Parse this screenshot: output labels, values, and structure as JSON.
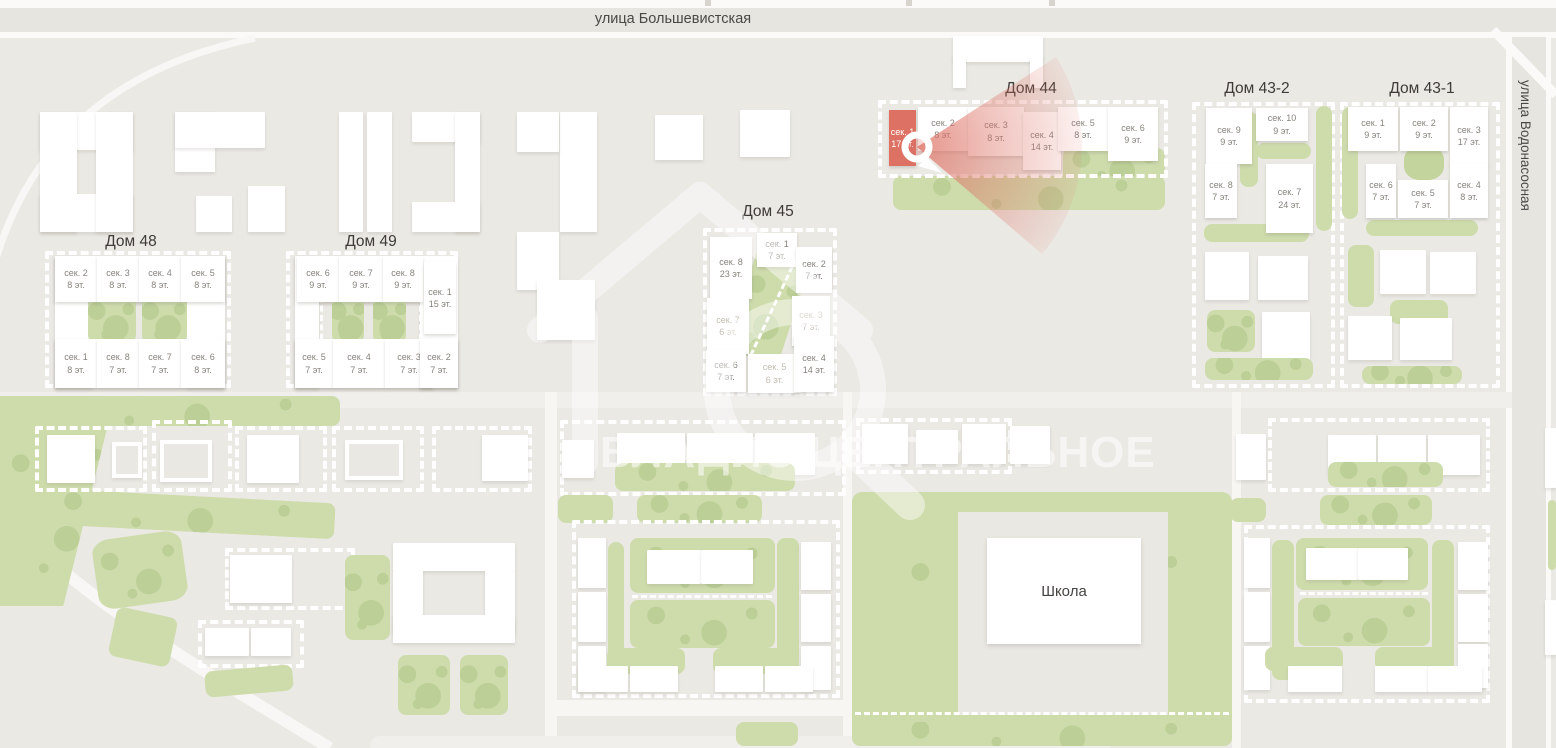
{
  "streets": {
    "top": "улица Большевистская",
    "right": "улица Водонасосная"
  },
  "school": {
    "label": "Школа"
  },
  "watermark": {
    "text": "ВЛАДИС ЦЕНТРАЛЬНОЕ"
  },
  "selection": {
    "house": "Дом 44",
    "section": "сек. 1",
    "floors": "17 эт."
  },
  "colors": {
    "accent_red": "#dd7164",
    "green": "#cedcac",
    "background": "#ebe9e4"
  },
  "houses": [
    {
      "title": "Дом 44",
      "sections": [
        {
          "name": "сек. 1",
          "floors": "17 эт.",
          "state": "selected"
        },
        {
          "name": "сек. 2",
          "floors": "8 эт.",
          "state": "normal"
        },
        {
          "name": "сек. 3",
          "floors": "8 эт.",
          "state": "normal"
        },
        {
          "name": "сек. 4",
          "floors": "14 эт.",
          "state": "normal"
        },
        {
          "name": "сек. 5",
          "floors": "8 эт.",
          "state": "normal"
        },
        {
          "name": "сек. 6",
          "floors": "9 эт.",
          "state": "normal"
        }
      ]
    },
    {
      "title": "Дом 45",
      "sections": [
        {
          "name": "сек. 8",
          "floors": "23 эт.",
          "state": "normal"
        },
        {
          "name": "сек. 1",
          "floors": "7 эт.",
          "state": "normal"
        },
        {
          "name": "сек. 2",
          "floors": "7 эт.",
          "state": "normal"
        },
        {
          "name": "сек. 7",
          "floors": "6 эт.",
          "state": "muted"
        },
        {
          "name": "сек. 3",
          "floors": "7 эт.",
          "state": "muted"
        },
        {
          "name": "сек. 6",
          "floors": "7 эт.",
          "state": "normal"
        },
        {
          "name": "сек. 5",
          "floors": "6 эт.",
          "state": "muted"
        },
        {
          "name": "сек. 4",
          "floors": "14 эт.",
          "state": "normal"
        }
      ]
    },
    {
      "title": "Дом 48",
      "sections": [
        {
          "name": "сек. 2",
          "floors": "8 эт.",
          "state": "normal"
        },
        {
          "name": "сек. 3",
          "floors": "8 эт.",
          "state": "normal"
        },
        {
          "name": "сек. 4",
          "floors": "8 эт.",
          "state": "normal"
        },
        {
          "name": "сек. 5",
          "floors": "8 эт.",
          "state": "normal"
        },
        {
          "name": "сек. 1",
          "floors": "8 эт.",
          "state": "normal"
        },
        {
          "name": "сек. 8",
          "floors": "7 эт.",
          "state": "normal"
        },
        {
          "name": "сек. 7",
          "floors": "7 эт.",
          "state": "normal"
        },
        {
          "name": "сек. 6",
          "floors": "8 эт.",
          "state": "normal"
        }
      ]
    },
    {
      "title": "Дом 49",
      "sections": [
        {
          "name": "сек. 6",
          "floors": "9 эт.",
          "state": "normal"
        },
        {
          "name": "сек. 7",
          "floors": "9 эт.",
          "state": "normal"
        },
        {
          "name": "сек. 8",
          "floors": "9 эт.",
          "state": "normal"
        },
        {
          "name": "сек. 1",
          "floors": "15 эт.",
          "state": "normal"
        },
        {
          "name": "сек. 5",
          "floors": "7 эт.",
          "state": "normal"
        },
        {
          "name": "сек. 4",
          "floors": "7 эт.",
          "state": "normal"
        },
        {
          "name": "сек. 3",
          "floors": "7 эт.",
          "state": "normal"
        },
        {
          "name": "сек. 2",
          "floors": "7 эт.",
          "state": "normal"
        }
      ]
    },
    {
      "title": "Дом 43-2",
      "sections": [
        {
          "name": "сек. 9",
          "floors": "9 эт.",
          "state": "normal"
        },
        {
          "name": "сек. 10",
          "floors": "9 эт.",
          "state": "normal"
        },
        {
          "name": "сек. 8",
          "floors": "7 эт.",
          "state": "normal"
        },
        {
          "name": "сек. 7",
          "floors": "24 эт.",
          "state": "normal"
        }
      ]
    },
    {
      "title": "Дом 43-1",
      "sections": [
        {
          "name": "сек. 1",
          "floors": "9 эт.",
          "state": "normal"
        },
        {
          "name": "сек. 2",
          "floors": "9 эт.",
          "state": "normal"
        },
        {
          "name": "сек. 3",
          "floors": "17 эт.",
          "state": "normal"
        },
        {
          "name": "сек. 6",
          "floors": "7 эт.",
          "state": "normal"
        },
        {
          "name": "сек. 5",
          "floors": "7 эт.",
          "state": "normal"
        },
        {
          "name": "сек. 4",
          "floors": "8 эт.",
          "state": "normal"
        }
      ]
    }
  ]
}
